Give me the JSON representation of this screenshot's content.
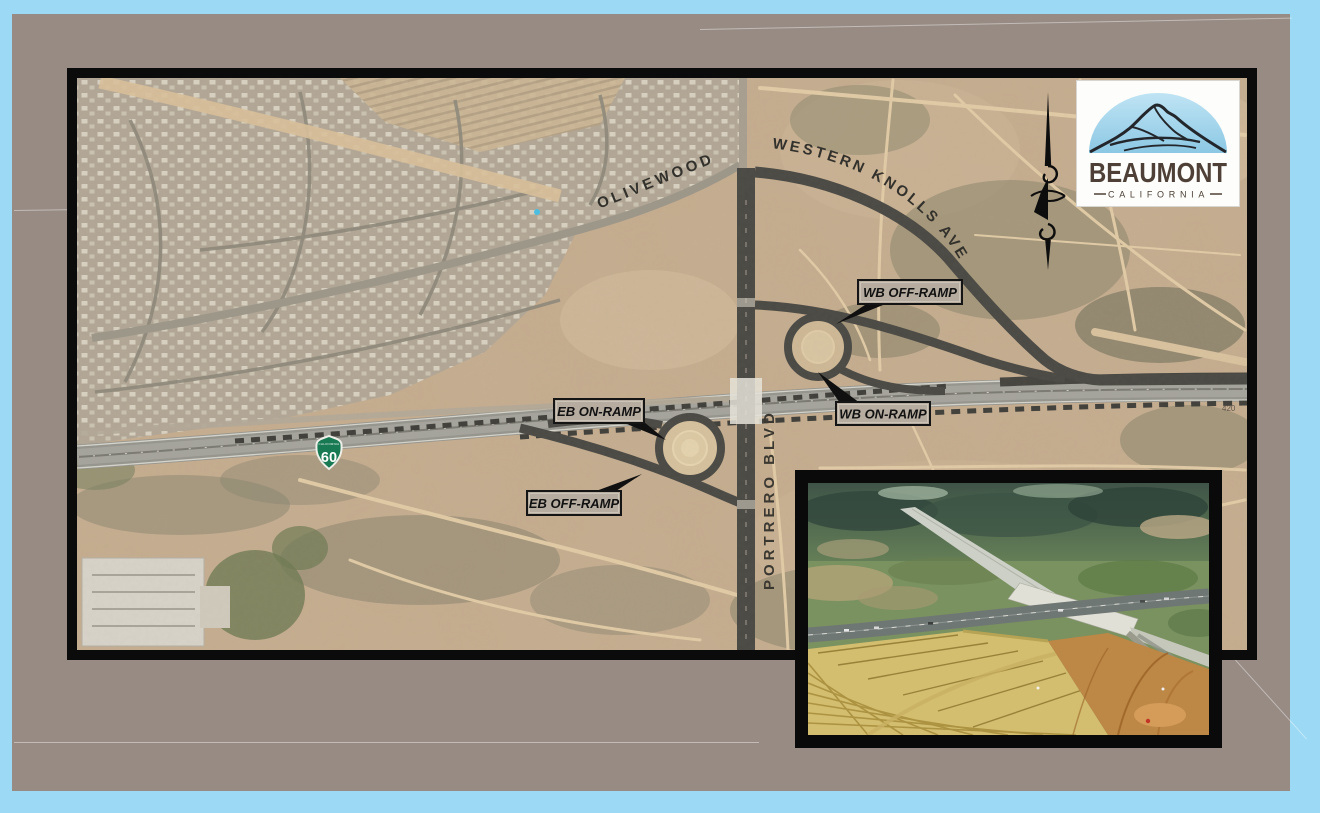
{
  "slide": {
    "canvas_color": "#9cd9f4",
    "background_color": "#978b84"
  },
  "map": {
    "street_labels": {
      "olivewood": "OLIVEWOOD",
      "western_knolls": "WESTERN KNOLLS AVE",
      "portrero": "PORTRERO BLVD"
    },
    "ramp_labels": {
      "wb_off": "WB OFF-RAMP",
      "wb_on": "WB ON-RAMP",
      "eb_on": "EB ON-RAMP",
      "eb_off": "EB OFF-RAMP"
    },
    "route_shield": {
      "route": "60",
      "state": "CALIFORNIA",
      "color": "#177a52"
    },
    "station_marker": "420",
    "colors": {
      "terrain_tan": "#c5ac8e",
      "new_road_dark": "#4a4944",
      "freeway_gray": "#96958e",
      "existing_road": "#a89f90",
      "label_box_bg": "#b6aca0",
      "map_border": "#0b0b0b"
    }
  },
  "logo": {
    "city": "BEAUMONT",
    "state": "CALIFORNIA",
    "dome_color": "#9ed2ea",
    "text_color": "#4e4036"
  }
}
